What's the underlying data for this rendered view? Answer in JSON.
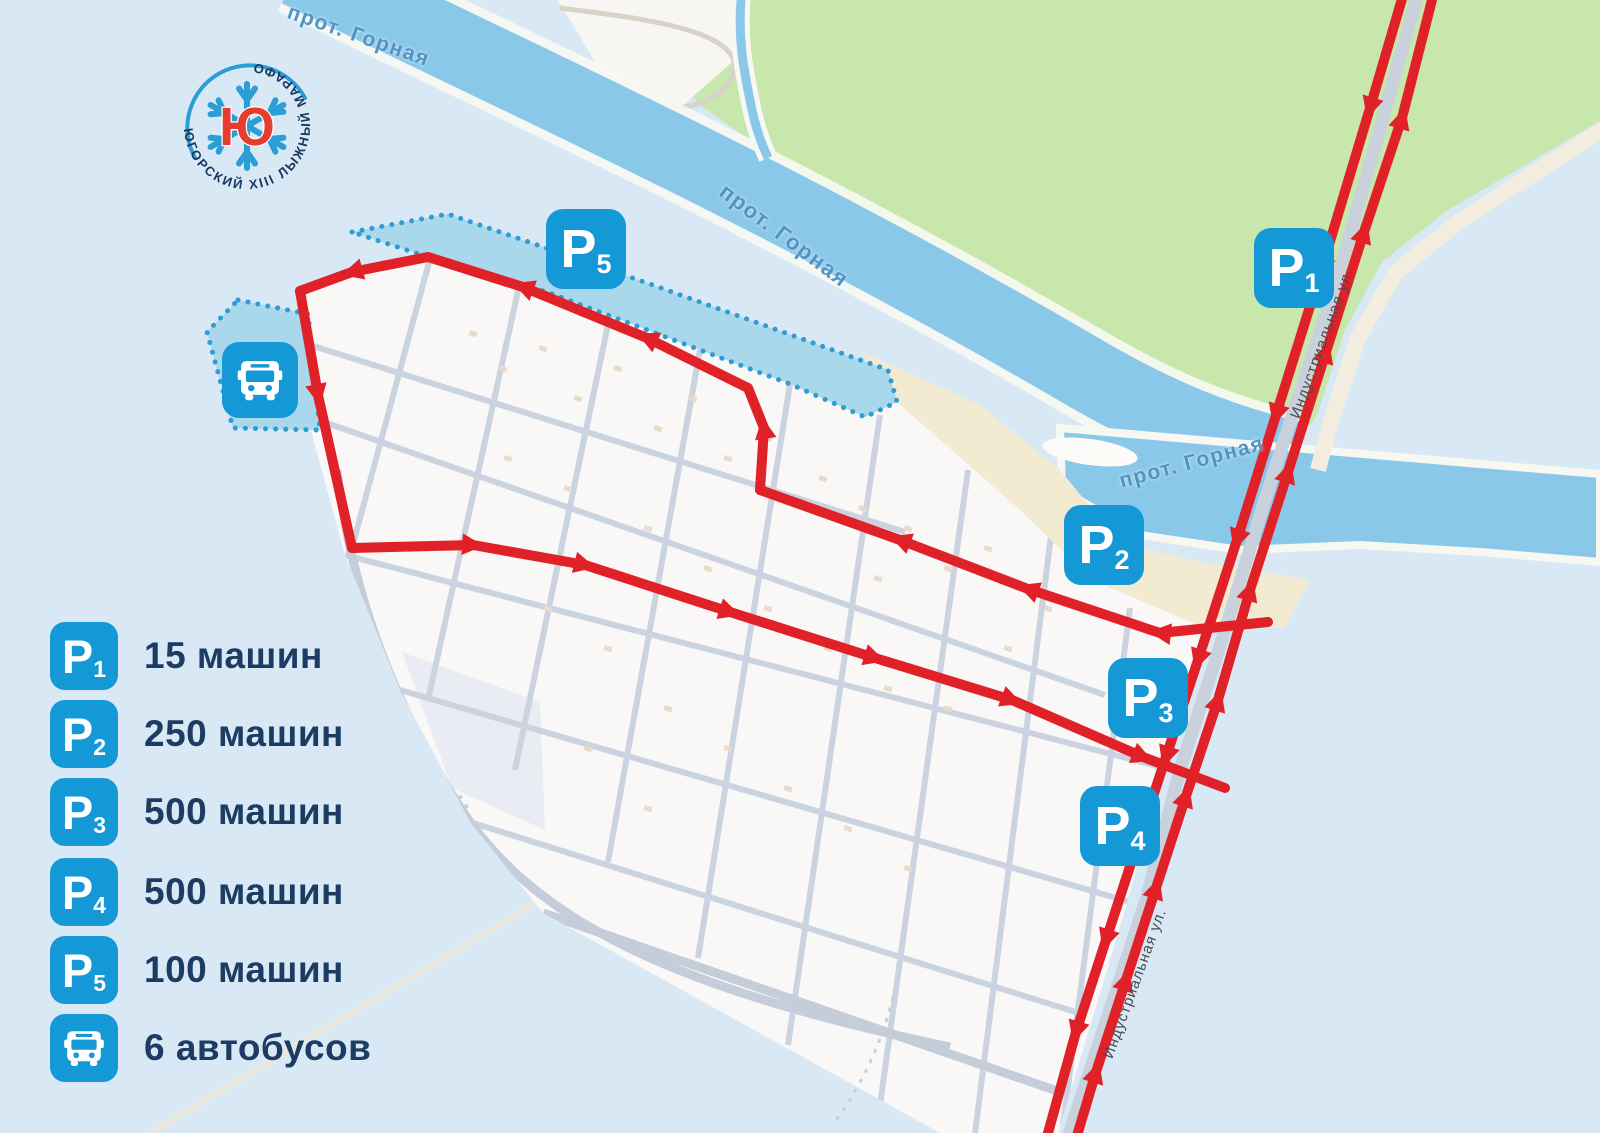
{
  "logo": {
    "circular_text": "ЮГОРСКИЙ XIII ЛЫЖНЫЙ МАРАФОН",
    "center_letter": "Ю"
  },
  "map": {
    "river_labels": [
      "прот. Горная",
      "прот. Горная",
      "прот. Горная"
    ],
    "street_labels": [
      "Индустриальная ул.",
      "Индустриальная ул."
    ],
    "badges": {
      "p1": {
        "letter": "P",
        "sub": "1"
      },
      "p2": {
        "letter": "P",
        "sub": "2"
      },
      "p3": {
        "letter": "P",
        "sub": "3"
      },
      "p4": {
        "letter": "P",
        "sub": "4"
      },
      "p5": {
        "letter": "P",
        "sub": "5"
      }
    }
  },
  "legend": {
    "items": [
      {
        "icon": "P1",
        "letter": "P",
        "sub": "1",
        "label": "15 машин"
      },
      {
        "icon": "P2",
        "letter": "P",
        "sub": "2",
        "label": "250 машин"
      },
      {
        "icon": "P3",
        "letter": "P",
        "sub": "3",
        "label": "500 машин"
      },
      {
        "icon": "P4",
        "letter": "P",
        "sub": "4",
        "label": "500 машин"
      },
      {
        "icon": "P5",
        "letter": "P",
        "sub": "5",
        "label": "100 машин"
      },
      {
        "icon": "bus",
        "label": "6 автобусов"
      }
    ]
  },
  "colors": {
    "route_red": "#e02128",
    "badge_blue": "#1598d6",
    "navy_text": "#1c3c63",
    "river_blue": "#8ac8ea",
    "green_land": "#c8e7ac",
    "sand": "#f3ead2"
  }
}
